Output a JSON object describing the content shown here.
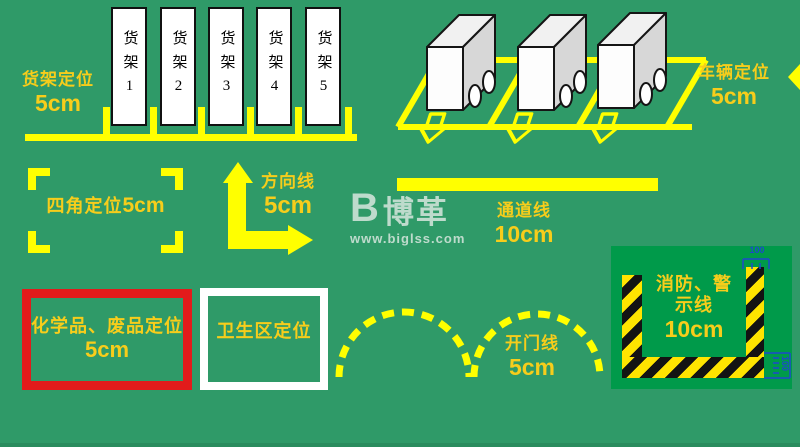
{
  "diagram_title": "工厂定置划线标准示意图",
  "shelf_area": {
    "label": "货架定位",
    "size": "5cm",
    "shelves": [
      "货架1",
      "货架2",
      "货架3",
      "货架4",
      "货架5"
    ]
  },
  "vehicle_area": {
    "label": "车辆定位",
    "size": "5cm"
  },
  "corner_area": {
    "label": "四角定位",
    "size": "5cm"
  },
  "direction_area": {
    "label": "方向线",
    "size": "5cm"
  },
  "channel_area": {
    "label": "通道线",
    "size": "10cm"
  },
  "chemical_area": {
    "label": "化学品、废品定位",
    "size": "5cm"
  },
  "hygiene_area": {
    "label": "卫生区定位"
  },
  "door_area": {
    "label": "开门线",
    "size": "5cm"
  },
  "fire_area": {
    "label_line1": "消防、警",
    "label_line2": "示线",
    "size": "10cm",
    "dim_top": "100",
    "dim_side": "100"
  },
  "watermark": {
    "logo_letter": "B",
    "logo": "博革",
    "url": "www.biglss.com"
  },
  "colors": {
    "background": "#2f9a68",
    "panel_green": "#009a4a",
    "line_yellow": "#ffff00",
    "label_gold": "#f7cd1b",
    "box_red": "#e21b1b",
    "box_white": "#ffffff",
    "hazard_yellow": "#ffe400",
    "hazard_black": "#131313",
    "dimension_blue": "#1d49cc"
  }
}
